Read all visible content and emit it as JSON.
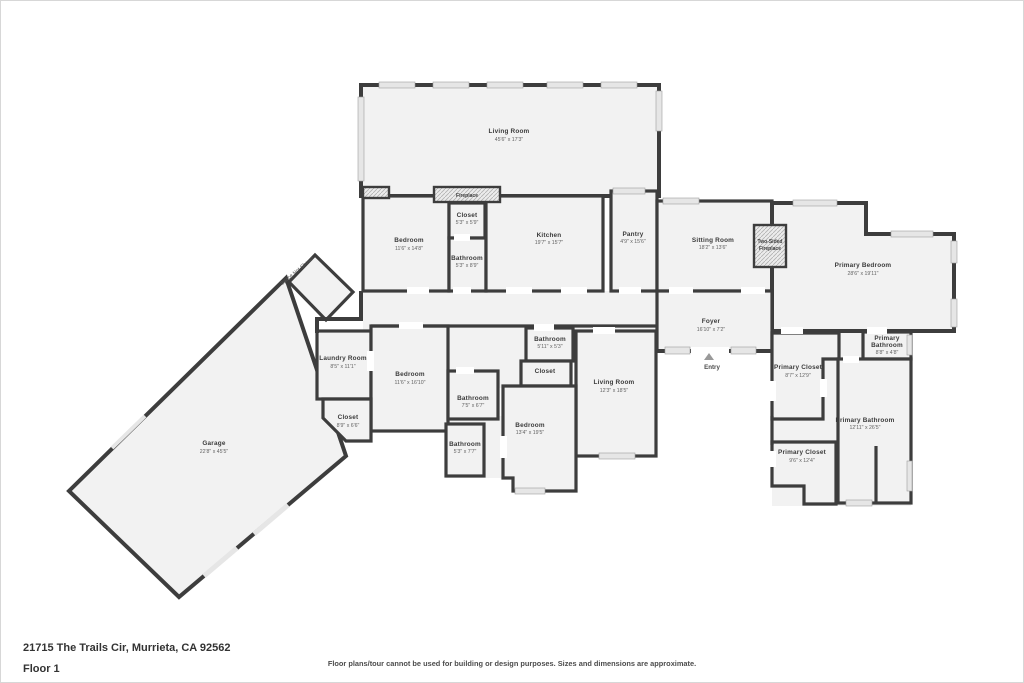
{
  "page": {
    "address": "21715 The Trails Cir, Murrieta, CA 92562",
    "floor_label": "Floor 1",
    "disclaimer": "Floor plans/tour cannot be used for building or design purposes. Sizes and dimensions are approximate."
  },
  "plan": {
    "space_note": "Space Not Shown",
    "entry_label": "Entry",
    "fireplace_label": "Fireplace",
    "two_sided_fireplace": {
      "line1": "Two-Sided",
      "line2": "Fireplace"
    },
    "colors": {
      "wall": "#3d3d3d",
      "room_fill": "#f2f2f2",
      "window": "#e6e6e6",
      "label": "#3b3b3b",
      "dims": "#636363"
    },
    "rooms": [
      {
        "id": "living-room-main",
        "name": "Living Room",
        "dims": "45'6\" x 17'3\""
      },
      {
        "id": "bedroom-1",
        "name": "Bedroom",
        "dims": "11'6\" x 14'8\""
      },
      {
        "id": "closet-1",
        "name": "Closet",
        "dims": "5'3\" x 5'9\""
      },
      {
        "id": "bathroom-1",
        "name": "Bathroom",
        "dims": "5'3\" x 8'9\""
      },
      {
        "id": "kitchen",
        "name": "Kitchen",
        "dims": "19'7\" x 15'7\""
      },
      {
        "id": "pantry",
        "name": "Pantry",
        "dims": "4'9\" x 15'6\""
      },
      {
        "id": "sitting-room",
        "name": "Sitting Room",
        "dims": "18'2\" x 13'6\""
      },
      {
        "id": "primary-bedroom",
        "name": "Primary Bedroom",
        "dims": "28'6\" x 19'11\""
      },
      {
        "id": "foyer",
        "name": "Foyer",
        "dims": "16'10\" x 7'2\""
      },
      {
        "id": "laundry-room",
        "name": "Laundry Room",
        "dims": "8'5\" x 11'1\""
      },
      {
        "id": "bedroom-2",
        "name": "Bedroom",
        "dims": "11'6\" x 16'10\""
      },
      {
        "id": "closet-2",
        "name": "Closet",
        "dims": "8'9\" x 6'6\""
      },
      {
        "id": "bathroom-2",
        "name": "Bathroom",
        "dims": "7'5\" x 6'7\""
      },
      {
        "id": "bathroom-3",
        "name": "Bathroom",
        "dims": "5'11\" x 5'3\""
      },
      {
        "id": "closet-3",
        "name": "Closet",
        "dims": ""
      },
      {
        "id": "living-room-2",
        "name": "Living Room",
        "dims": "12'3\" x 18'5\""
      },
      {
        "id": "bedroom-3",
        "name": "Bedroom",
        "dims": "13'4\" x 19'5\""
      },
      {
        "id": "bathroom-4",
        "name": "Bathroom",
        "dims": "5'3\" x 7'7\""
      },
      {
        "id": "primary-closet-1",
        "name": "Primary Closet",
        "dims": "8'7\" x 12'9\""
      },
      {
        "id": "primary-bathroom-1",
        "name": "Primary Bathroom",
        "name_line1": "Primary",
        "name_line2": "Bathroom",
        "dims": "8'8\" x 4'8\""
      },
      {
        "id": "primary-bathroom-2",
        "name": "Primary Bathroom",
        "dims": "12'11\" x 26'5\""
      },
      {
        "id": "primary-closet-2",
        "name": "Primary Closet",
        "dims": "9'6\" x 12'4\""
      },
      {
        "id": "garage",
        "name": "Garage",
        "dims": "22'8\" x 45'5\""
      }
    ]
  }
}
